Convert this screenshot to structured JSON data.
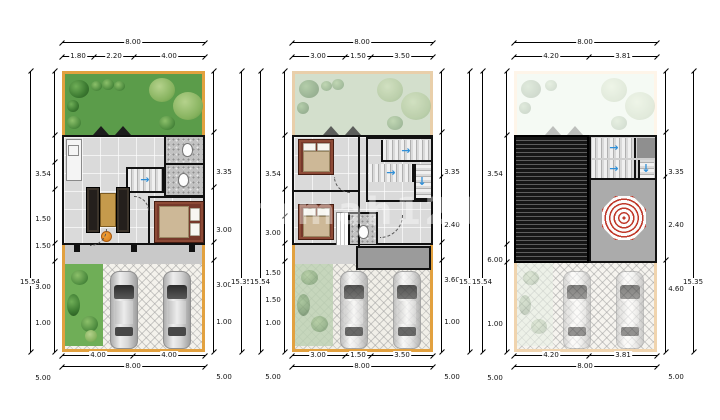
{
  "watermark": "rumah123",
  "colors": {
    "plot_border": "#e2a13f",
    "garden_green": "#5b9c4a",
    "stair_arrow": "#2f8fd8",
    "umbrella_red": "#c0392b",
    "roof_dark": "#161616"
  },
  "arrows": {
    "right": "→",
    "down": "↓"
  },
  "panels": [
    {
      "top_total": "8.00",
      "top_subs": [
        "1.80",
        "2.20",
        "4.00"
      ],
      "left_total": "15.54",
      "left_dims": [
        "3.54",
        "1.50",
        "1.50",
        "3.00",
        "1.00",
        "5.00"
      ],
      "right_total": "15.35",
      "right_dims": [
        "3.35",
        "3.00",
        "3.00",
        "1.00",
        "5.00"
      ],
      "bottom_subs": [
        "4.00",
        "4.00"
      ],
      "bottom_total": "8.00"
    },
    {
      "top_total": "8.00",
      "top_subs": [
        "3.00",
        "1.50",
        "3.50"
      ],
      "left_total": "15.54",
      "left_dims": [
        "3.54",
        "3.00",
        "1.50",
        "1.50",
        "1.00",
        "5.00"
      ],
      "right_total": "15.35",
      "right_dims": [
        "3.35",
        "2.40",
        "3.60",
        "1.00",
        "5.00"
      ],
      "bottom_subs": [
        "3.00",
        "1.50",
        "3.50"
      ],
      "bottom_total": "8.00"
    },
    {
      "top_total": "8.00",
      "top_subs": [
        "4.20",
        "3.81"
      ],
      "left_total": "15.54",
      "left_dims": [
        "3.54",
        "6.00",
        "1.00",
        "5.00"
      ],
      "right_total": "15.35",
      "right_dims": [
        "3.35",
        "2.40",
        "4.60",
        "5.00"
      ],
      "bottom_subs": [
        "4.20",
        "3.81"
      ],
      "bottom_total": "8.00"
    }
  ]
}
